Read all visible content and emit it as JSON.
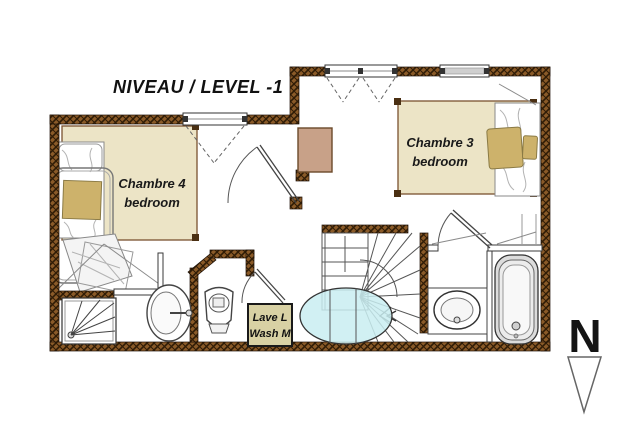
{
  "title": "NIVEAU / LEVEL -1",
  "rooms": {
    "chambre4": {
      "label_fr": "Chambre 4",
      "label_en": "bedroom"
    },
    "chambre3": {
      "label_fr": "Chambre 3",
      "label_en": "bedroom"
    }
  },
  "appliance": {
    "line1": "Lave L",
    "line2": "Wash M"
  },
  "compass": {
    "label": "N"
  },
  "colors": {
    "wall_brown": "#8a5a28",
    "wall_hatch": "#2f1c06",
    "room_beige": "#ece4c6",
    "bedding_tan": "#cdb26b",
    "wardrobe_tan": "#c8a188",
    "washer_box": "#d8d1a4",
    "water_heater_cyan": "#c9edf1"
  }
}
